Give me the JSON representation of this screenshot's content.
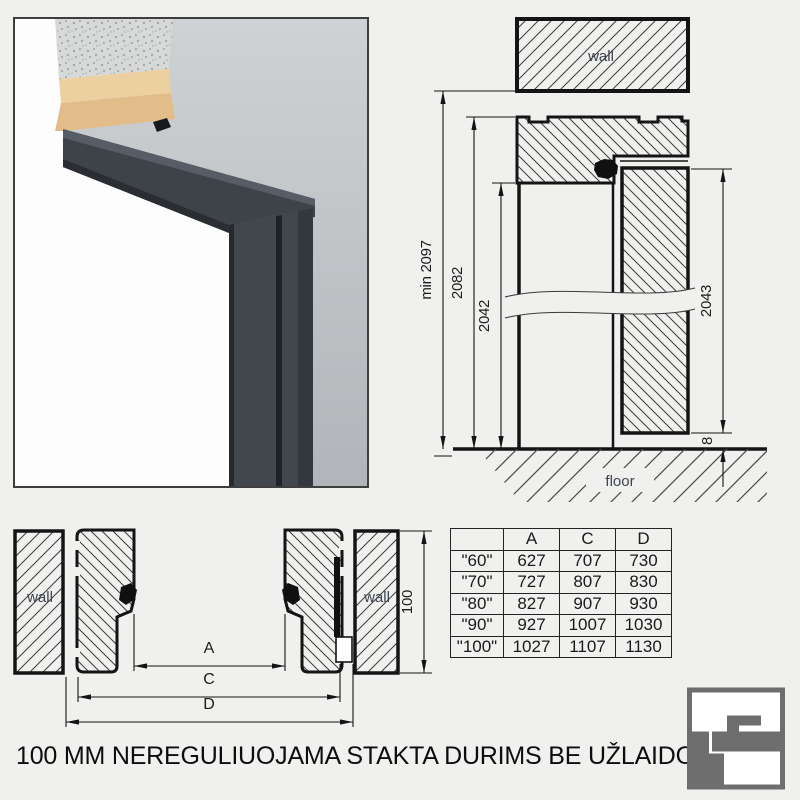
{
  "title": "100 MM NEREGULIUOJAMA STAKTA DURIMS BE UŽLAIDOS",
  "colors": {
    "page_bg": "#f0f0ee",
    "drawing_line": "#141414",
    "annotation_text": "#3d4450",
    "frame_anthracite": "#3f444b",
    "wall_grey": "#bfc3c7",
    "plaster_tan": "#e3bf8c",
    "concrete_grey": "#d7d9d8",
    "logo_grey": "#6e6e6e"
  },
  "vertical_section": {
    "wall_label": "wall",
    "floor_label": "floor",
    "dims": {
      "min_total": "min 2097",
      "frame_outer": "2082",
      "opening": "2042",
      "leaf": "2043",
      "floor_gap": "8"
    }
  },
  "plan_section": {
    "wall_left_label": "wall",
    "wall_right_label": "wall",
    "dims": {
      "a": "A",
      "c": "C",
      "d": "D",
      "depth": "100"
    }
  },
  "table": {
    "headers": [
      "",
      "A",
      "C",
      "D"
    ],
    "rows": [
      [
        "\"60\"",
        "627",
        "707",
        "730"
      ],
      [
        "\"70\"",
        "727",
        "807",
        "830"
      ],
      [
        "\"80\"",
        "827",
        "907",
        "930"
      ],
      [
        "\"90\"",
        "927",
        "1007",
        "1030"
      ],
      [
        "\"100\"",
        "1027",
        "1107",
        "1130"
      ]
    ]
  }
}
